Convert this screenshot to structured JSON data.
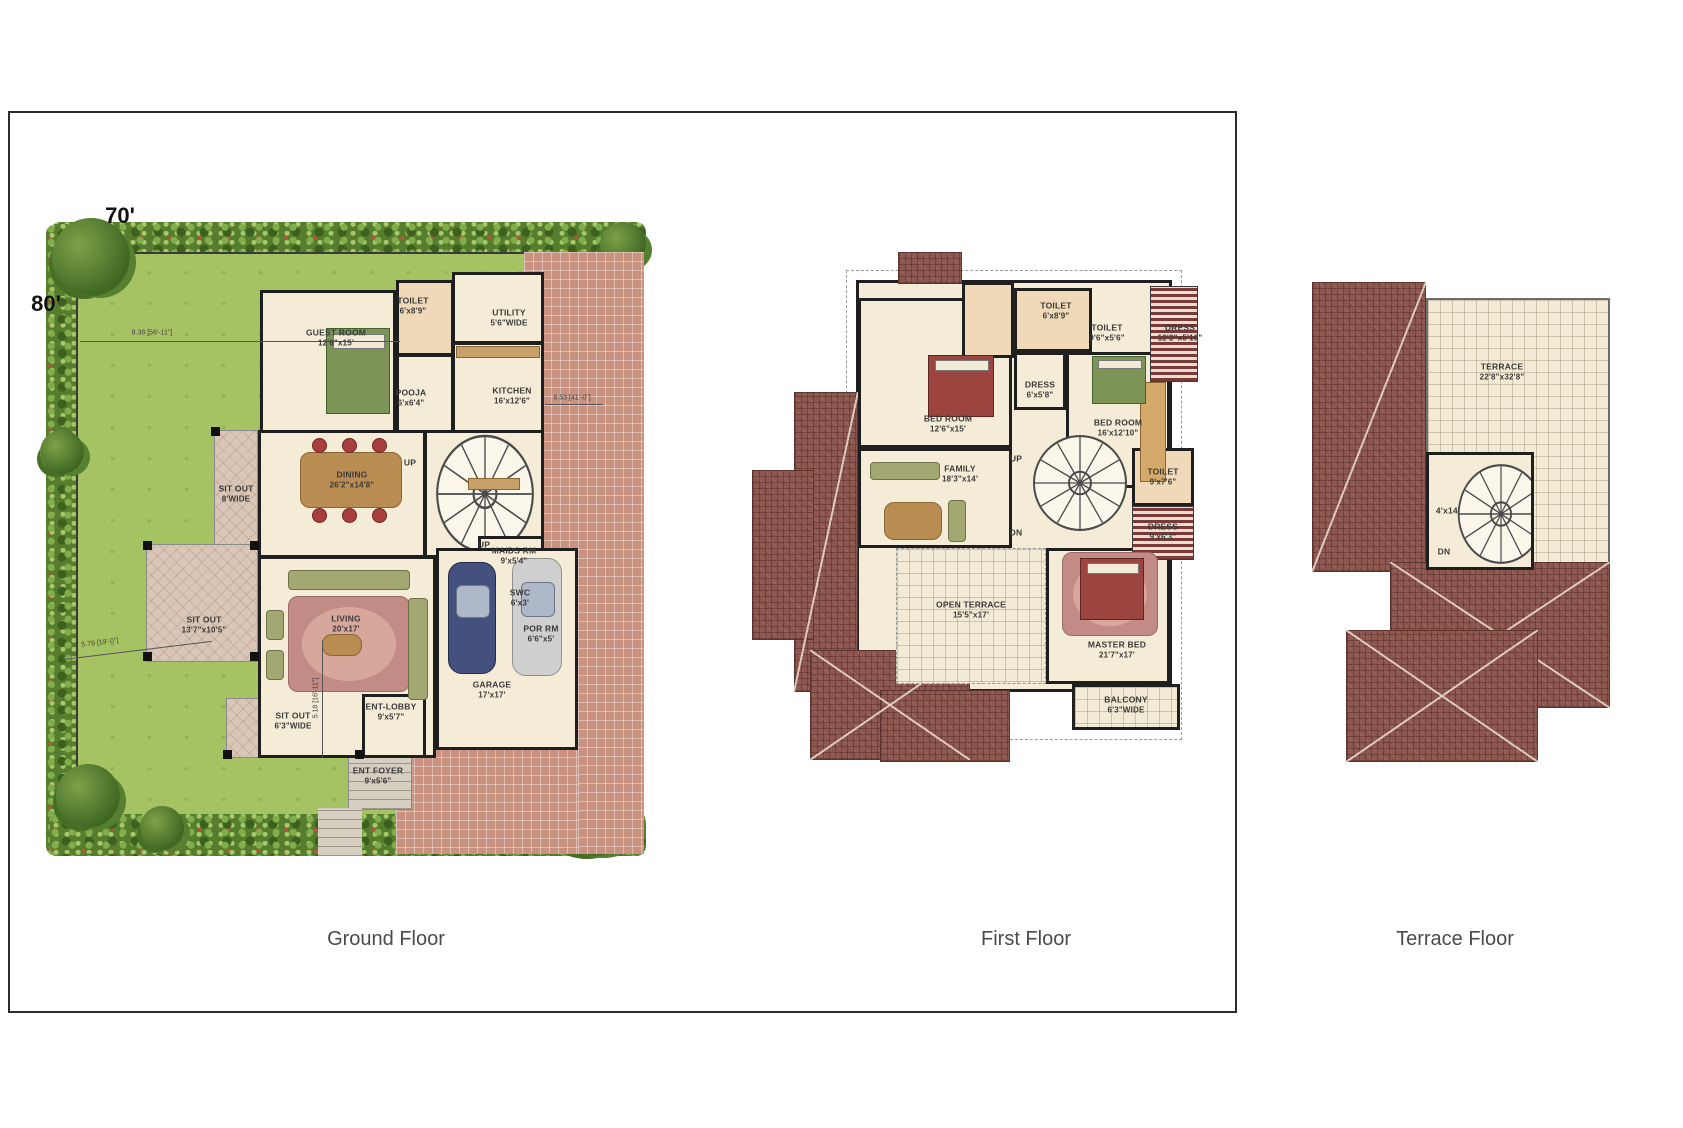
{
  "captions": {
    "ground": "Ground Floor",
    "first": "First Floor",
    "terrace": "Terrace Floor"
  },
  "plot_dims": {
    "width": "70'",
    "height": "80'"
  },
  "site_annotations": {
    "a1": "8.38 [56'-11\"]",
    "a2": "8.53 [41'-0\"]",
    "a3": "5.79 [19'-0\"]",
    "a4": "5.18 [16'-11\"]"
  },
  "ground_floor": {
    "labels": [
      {
        "name": "GUEST ROOM",
        "dims": "12'6\"x15'"
      },
      {
        "name": "TOILET",
        "dims": "6'x8'9\""
      },
      {
        "name": "UTILITY",
        "dims": "5'6\"WIDE"
      },
      {
        "name": "POOJA",
        "dims": "6'x6'4\""
      },
      {
        "name": "KITCHEN",
        "dims": "16'x12'6\""
      },
      {
        "name": "DINING",
        "dims": "26'2\"x14'8\""
      },
      {
        "name": "MAIDS RM",
        "dims": "9'x5'4\""
      },
      {
        "name": "SWC",
        "dims": "6'x3'"
      },
      {
        "name": "POR RM",
        "dims": "6'6\"x5'"
      },
      {
        "name": "SIT OUT",
        "dims": "8'WIDE"
      },
      {
        "name": "SIT OUT",
        "dims": "13'7\"x10'5\""
      },
      {
        "name": "LIVING",
        "dims": "20'x17'"
      },
      {
        "name": "GARAGE",
        "dims": "17'x17'"
      },
      {
        "name": "SIT OUT",
        "dims": "6'3\"WIDE"
      },
      {
        "name": "ENT-LOBBY",
        "dims": "9'x5'7\""
      },
      {
        "name": "ENT FOYER",
        "dims": "9'x5'6\""
      },
      {
        "name": "UP",
        "dims": ""
      },
      {
        "name": "UP",
        "dims": ""
      }
    ]
  },
  "first_floor": {
    "labels": [
      {
        "name": "TOILET",
        "dims": "6'x8'9\""
      },
      {
        "name": "TOILET",
        "dims": "9'6\"x5'6\""
      },
      {
        "name": "DRESS",
        "dims": "12'2\"x5'10\""
      },
      {
        "name": "BED ROOM",
        "dims": "12'6\"x15'"
      },
      {
        "name": "DRESS",
        "dims": "6'x5'8\""
      },
      {
        "name": "BED ROOM",
        "dims": "16'x12'10\""
      },
      {
        "name": "FAMILY",
        "dims": "18'3\"x14'"
      },
      {
        "name": "TOILET",
        "dims": "9'x7'6\""
      },
      {
        "name": "DRESS",
        "dims": "9'x6'3\""
      },
      {
        "name": "OPEN TERRACE",
        "dims": "15'5\"x17'"
      },
      {
        "name": "MASTER BED",
        "dims": "21'7\"x17'"
      },
      {
        "name": "BALCONY",
        "dims": "6'3\"WIDE"
      },
      {
        "name": "UP",
        "dims": ""
      },
      {
        "name": "DN",
        "dims": ""
      }
    ]
  },
  "terrace_floor": {
    "labels": [
      {
        "name": "TERRACE",
        "dims": "22'8\"x32'8\""
      },
      {
        "name": "4'x14'",
        "dims": ""
      },
      {
        "name": "DN",
        "dims": ""
      }
    ]
  },
  "icons": {
    "spiral_stair": "svg-fan-of-treads",
    "car": "css-rounded-rect-with-windshield",
    "bed": "css-rect-with-pillow",
    "tree": "css-radial-blob"
  },
  "colors": {
    "lawn": "#a6c364",
    "hedge": "#567d2e",
    "paving": "#c9917f",
    "floor": "#f4ecd6",
    "wall": "#1f1f1f",
    "roof": "#8d564e",
    "bed_green": "#7d9457",
    "bed_red": "#9c4540",
    "caption_text": "#4a4a4a"
  }
}
